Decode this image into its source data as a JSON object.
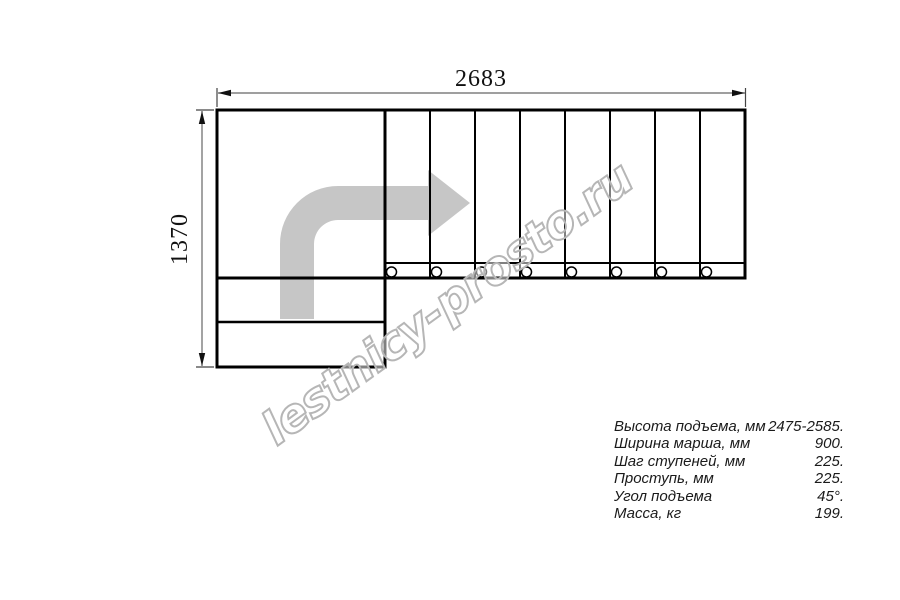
{
  "diagram": {
    "top_dimension": "2683",
    "left_dimension": "1370",
    "tread_count": 8
  },
  "watermark": {
    "text": "lestnicy-prosto.ru"
  },
  "specs": [
    {
      "label": "Высота подъема, мм",
      "value": "2475-2585."
    },
    {
      "label": "Ширина марша, мм",
      "value": "900."
    },
    {
      "label": "Шаг ступеней, мм",
      "value": "225."
    },
    {
      "label": "Проступь, мм",
      "value": "225."
    },
    {
      "label": "Угол подъема",
      "value": "45°."
    },
    {
      "label": "Масса, кг",
      "value": "199."
    }
  ],
  "colors": {
    "line": "#000000",
    "dimension_line": "#666666",
    "arrow_fill": "#c6c6c6",
    "watermark_outline": "#b6b6b6",
    "background": "#ffffff"
  }
}
